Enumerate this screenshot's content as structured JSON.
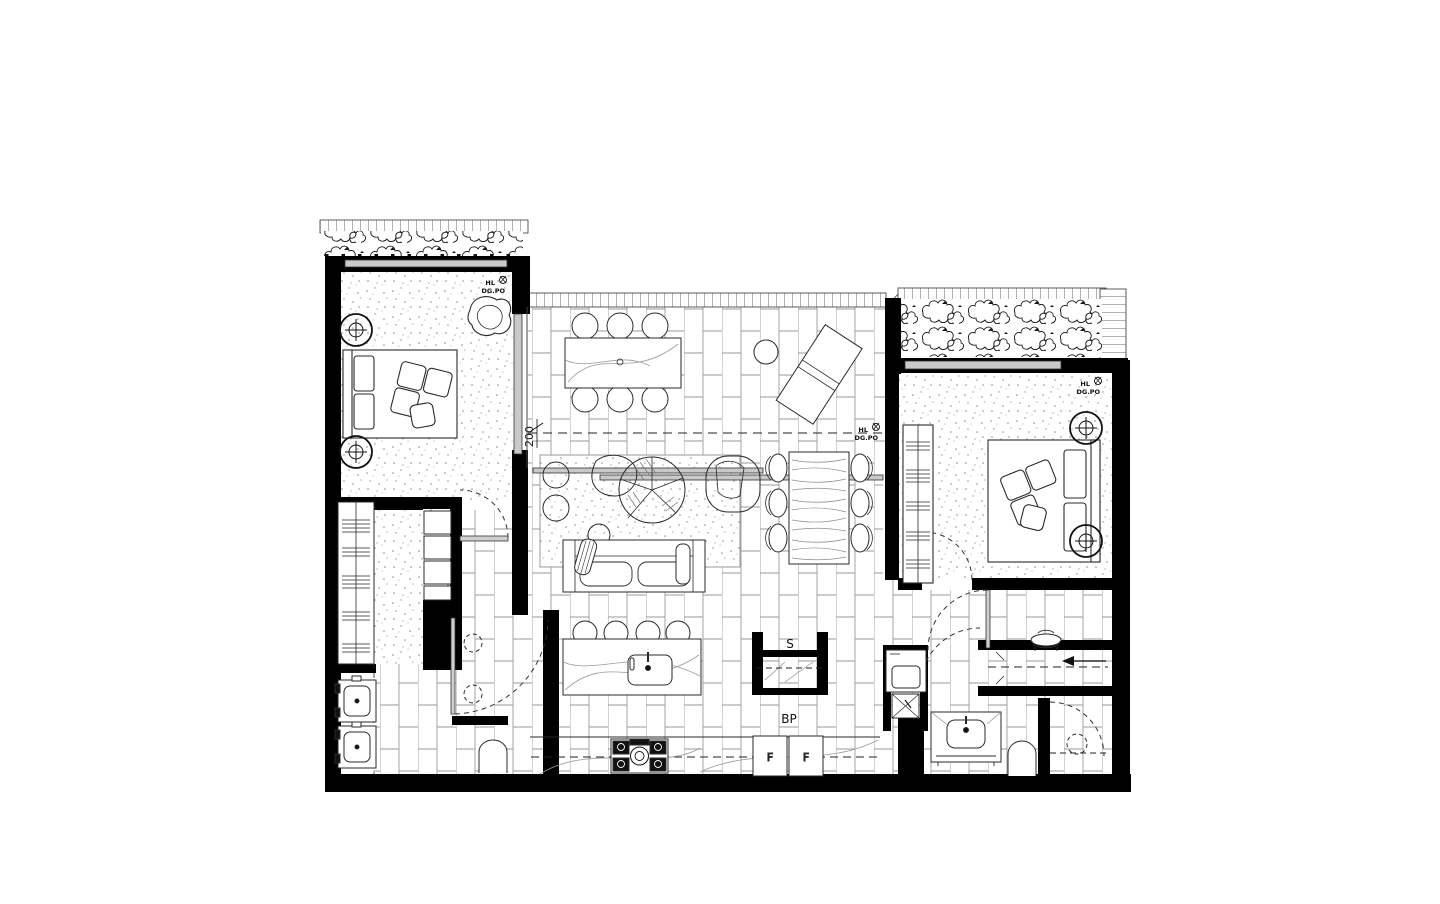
{
  "drawing": {
    "kind": "floor-plan",
    "labels": {
      "hl": "HL",
      "dgpo": "DG.PO",
      "dim_200": "200",
      "storage": "S",
      "bp": "BP",
      "fridge": "F"
    },
    "colors": {
      "wall": "#000000",
      "furniture_line": "#2a2a2a",
      "tile_joint": "#999999",
      "carpet_dot": "#8b8b8b",
      "glass": "#bdbdbd",
      "background": "#ffffff"
    }
  }
}
